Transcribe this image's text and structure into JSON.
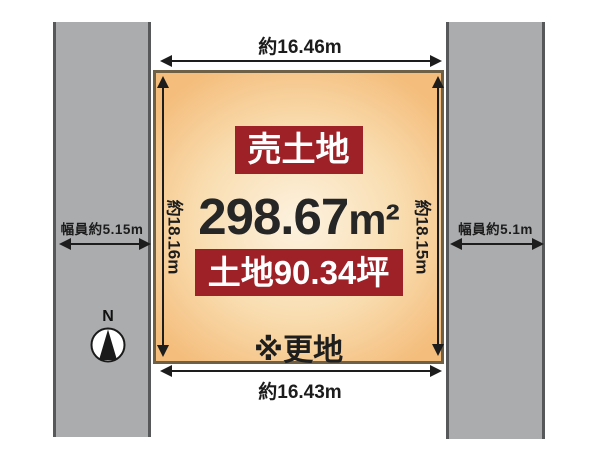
{
  "parcel": {
    "sale_badge": "売土地",
    "area_value": "298.67",
    "area_unit": "m²",
    "tsubo_badge": "土地90.34坪",
    "note": "※更地",
    "dim_top": "約16.46m",
    "dim_bottom": "約16.43m",
    "dim_left": "約18.16m",
    "dim_right": "約18.15m"
  },
  "roads": {
    "left": {
      "label": "幅員約5.15m"
    },
    "right": {
      "label": "幅員約5.1m"
    }
  },
  "compass": {
    "north_label": "N"
  },
  "colors": {
    "background": "#ffffff",
    "road_fill": "#aaacae",
    "road_border": "#57585a",
    "parcel_fill_center": "#fdf2e0",
    "parcel_fill_edge": "#f4bd7c",
    "parcel_border": "#6d6046",
    "badge_background": "#9d2127",
    "badge_text": "#ffffff",
    "line": "#1d1d1d",
    "text": "#1d1d1d"
  }
}
